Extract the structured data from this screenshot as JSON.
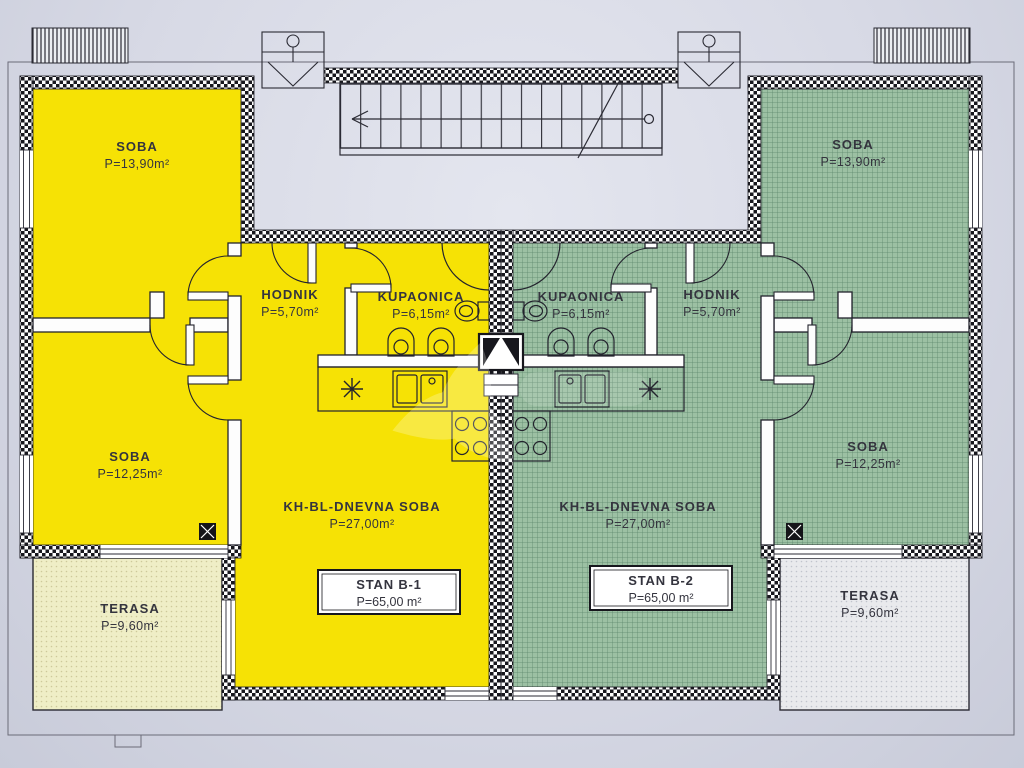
{
  "plan": {
    "colors": {
      "background": "#d7d9e5",
      "unit_b1_fill": "#f6e205",
      "unit_b2_fill": "#9cc0a3",
      "terrace_b1_fill": "#efeec6",
      "terrace_b2_fill": "#e9eaed",
      "wall_hatch": "#17171d",
      "linework": "#23232d"
    },
    "apartments": [
      {
        "unit": "STAN B-1",
        "unit_area": "P=65,00 m²",
        "rooms": {
          "soba1": {
            "label": "SOBA",
            "area": "P=13,90m²"
          },
          "soba2": {
            "label": "SOBA",
            "area": "P=12,25m²"
          },
          "hodnik": {
            "label": "HODNIK",
            "area": "P=5,70m²"
          },
          "kupaonica": {
            "label": "KUPAONICA",
            "area": "P=6,15m²"
          },
          "dnevna": {
            "label": "KH-BL-DNEVNA SOBA",
            "area": "P=27,00m²"
          },
          "terasa": {
            "label": "TERASA",
            "area": "P=9,60m²"
          }
        }
      },
      {
        "unit": "STAN B-2",
        "unit_area": "P=65,00 m²",
        "rooms": {
          "soba1": {
            "label": "SOBA",
            "area": "P=13,90m²"
          },
          "soba2": {
            "label": "SOBA",
            "area": "P=12,25m²"
          },
          "hodnik": {
            "label": "HODNIK",
            "area": "P=5,70m²"
          },
          "kupaonica": {
            "label": "KUPAONICA",
            "area": "P=6,15m²"
          },
          "dnevna": {
            "label": "KH-BL-DNEVNA SOBA",
            "area": "P=27,00m²"
          },
          "terasa": {
            "label": "TERASA",
            "area": "P=9,60m²"
          }
        }
      }
    ]
  }
}
